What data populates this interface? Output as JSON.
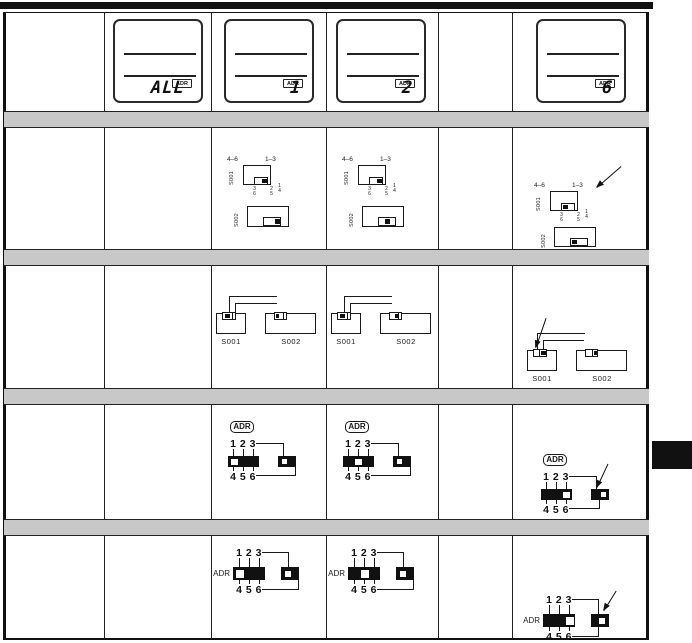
{
  "palette": {
    "ink": "#1a1a1a",
    "band_gray": "#c8c8c8",
    "paper": "#ffffff",
    "tab_black": "#111111"
  },
  "lcd_row": {
    "adr_badge": "ADR",
    "cells": [
      {
        "column": 2,
        "address": "ALL"
      },
      {
        "column": 3,
        "address": "1"
      },
      {
        "column": 4,
        "address": "2"
      },
      {
        "column": 6,
        "address": "6"
      }
    ]
  },
  "slide_switch_row": {
    "s001_label": "S001",
    "s002_label": "S002",
    "s001_range_left": "4–6",
    "s001_range_right": "1–3",
    "s002_position_labels": [
      {
        "top": "3",
        "bottom": "6"
      },
      {
        "top": "2",
        "bottom": "5"
      },
      {
        "top": "1",
        "bottom": "4"
      }
    ],
    "cells": [
      {
        "column": 3,
        "address": "1",
        "s001_position": "right",
        "s002_position": "right",
        "arrow": false
      },
      {
        "column": 4,
        "address": "2",
        "s001_position": "right",
        "s002_position": "middle",
        "arrow": false
      },
      {
        "column": 6,
        "address": "6",
        "s001_position": "left",
        "s002_position": "left",
        "arrow": true
      }
    ]
  },
  "connector_switch_row": {
    "s001_label": "S001",
    "s002_label": "S002",
    "cells": [
      {
        "column": 3,
        "address": "1",
        "s001_position": "left",
        "s002_position": "left",
        "arrow": false
      },
      {
        "column": 4,
        "address": "2",
        "s001_position": "left",
        "s002_position": "middle",
        "arrow": false
      },
      {
        "column": 6,
        "address": "6",
        "s001_position": "right",
        "s002_position": "right",
        "arrow": true
      }
    ]
  },
  "adr_boxed_row": {
    "adr_label": "ADR",
    "numbers_top": "1 2 3",
    "numbers_bottom": "4 5 6",
    "cells": [
      {
        "column": 3,
        "address": "1",
        "slider_position": 1,
        "range_switch": "left",
        "arrow": false
      },
      {
        "column": 4,
        "address": "2",
        "slider_position": 2,
        "range_switch": "left",
        "arrow": false
      },
      {
        "column": 6,
        "address": "6",
        "slider_position": 3,
        "range_switch": "right",
        "arrow": true
      }
    ]
  },
  "adr_inline_row": {
    "adr_label": "ADR",
    "numbers_top": "1 2 3",
    "numbers_bottom": "4 5 6",
    "cells": [
      {
        "column": 3,
        "address": "1",
        "slider_position": 1,
        "range_switch": "left",
        "arrow": false
      },
      {
        "column": 4,
        "address": "2",
        "slider_position": 2,
        "range_switch": "left",
        "arrow": false
      },
      {
        "column": 6,
        "address": "6",
        "slider_position": 3,
        "range_switch": "right",
        "arrow": true
      }
    ]
  }
}
